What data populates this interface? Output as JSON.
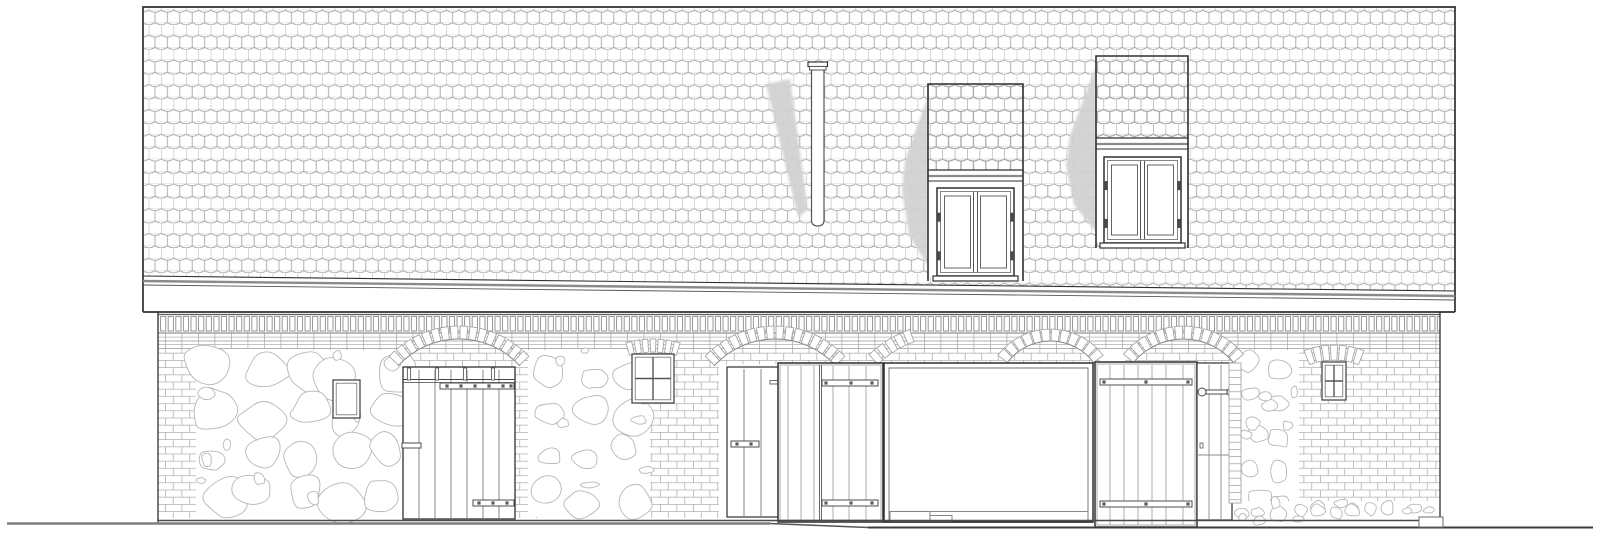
{
  "figure": {
    "kind": "architectural-elevation-drawing",
    "text_content": ""
  },
  "colors": {
    "bg": "#ffffff",
    "ink": "#2f2f2f",
    "mid": "#555555",
    "soft": "#7d7d7d",
    "tile_line": "#a2a2a2",
    "tile_faint": "#d8d8d8",
    "brick_line": "#b0b0b0",
    "band": "#8a8a8a",
    "stone": "#b7b7b7",
    "shadow": "#d2d2d2",
    "ground_l": "#7f7f7f",
    "ground_r": "#3d3d3d",
    "white": "#ffffff"
  },
  "scene": {
    "canvas": {
      "w": 1600,
      "h": 537
    },
    "patterns": {
      "tile": {
        "w": 12.4,
        "h": 12.4,
        "dip": 4.2,
        "head": 2.2
      },
      "brick": {
        "w": 16.5,
        "h": 7.2
      },
      "soldier": {
        "w": 7.6,
        "h": 17.5,
        "bw": 5.2,
        "bh": 14.5
      }
    },
    "roof": {
      "x1": 143,
      "x2": 1455,
      "top": 7,
      "eaveL": 276,
      "eaveR": 291,
      "bottom": 312
    },
    "chimney": {
      "x1": 811.5,
      "x2": 824,
      "top": 70,
      "bottom": 226,
      "cap": {
        "x1": 808,
        "x2": 827.5,
        "y1": 62,
        "y2": 70,
        "mid": 66.5
      },
      "shadow": [
        [
          766,
          84
        ],
        [
          790,
          79
        ],
        [
          808,
          210
        ],
        [
          798,
          217
        ]
      ]
    },
    "dormers": [
      {
        "x1": 928,
        "x2": 1023,
        "top": 84,
        "tiles_bottom": 170,
        "band": [
          170,
          176,
          181,
          188
        ],
        "win": {
          "x1": 937,
          "x2": 1014,
          "y1": 188,
          "y2": 276
        },
        "sill": {
          "x1": 933,
          "x2": 1018,
          "y1": 276,
          "y2": 281
        },
        "shadow": [
          [
            928,
            96
          ],
          [
            905,
            160
          ],
          [
            902,
            190
          ],
          [
            909,
            235
          ],
          [
            928,
            266
          ]
        ]
      },
      {
        "x1": 1096,
        "x2": 1188,
        "top": 56,
        "tiles_bottom": 138,
        "band": [
          138,
          144,
          149,
          157
        ],
        "win": {
          "x1": 1104,
          "x2": 1181,
          "y1": 157,
          "y2": 243
        },
        "sill": {
          "x1": 1100,
          "x2": 1185,
          "y1": 243,
          "y2": 248
        },
        "shadow": [
          [
            1096,
            66
          ],
          [
            1070,
            135
          ],
          [
            1066,
            165
          ],
          [
            1074,
            205
          ],
          [
            1096,
            232
          ]
        ]
      }
    ],
    "wall": {
      "x1": 158,
      "x2": 1440,
      "top": 312,
      "soldier": {
        "y1": 315.5,
        "y2": 333
      },
      "courses": [
        [
          333.5,
          341
        ],
        [
          341,
          348.5
        ]
      ],
      "base": 520.5,
      "base_right": 527
    },
    "brick_regions": [
      {
        "x": 158,
        "y": 348.5,
        "w": 42,
        "h": 169.5
      },
      {
        "x": 300,
        "y": 348.5,
        "w": 98,
        "h": 110
      },
      {
        "x": 513,
        "y": 348.5,
        "w": 33,
        "h": 169.5
      },
      {
        "x": 627,
        "y": 348.5,
        "w": 92,
        "h": 169.5
      },
      {
        "x": 831,
        "y": 348.5,
        "w": 53,
        "h": 15
      },
      {
        "x": 1232,
        "y": 348.5,
        "w": 208,
        "h": 154.5
      },
      {
        "x": 395,
        "y": 348.5,
        "w": 130,
        "h": 18
      },
      {
        "x": 705,
        "y": 348.5,
        "w": 135,
        "h": 16
      },
      {
        "x": 868,
        "y": 348.5,
        "w": 232,
        "h": 15
      },
      {
        "x": 1125,
        "y": 348.5,
        "w": 115,
        "h": 15
      }
    ],
    "stone_regions": [
      {
        "x": 196,
        "y": 350,
        "w": 210,
        "h": 167,
        "cols": 5,
        "rows": 4,
        "rmin": 16,
        "rmax": 27,
        "seed": 7,
        "pebbles": 10
      },
      {
        "x": 528,
        "y": 350,
        "w": 122,
        "h": 167,
        "cols": 3,
        "rows": 4,
        "rmin": 14,
        "rmax": 24,
        "seed": 11,
        "pebbles": 7
      },
      {
        "x": 1239,
        "y": 350,
        "w": 60,
        "h": 167,
        "cols": 2,
        "rows": 5,
        "rmin": 10,
        "rmax": 17,
        "seed": 23,
        "pebbles": 6
      },
      {
        "x": 1232,
        "y": 501,
        "w": 206,
        "h": 20,
        "cols": 11,
        "rows": 1,
        "rmin": 6,
        "rmax": 10,
        "seed": 31,
        "pebbles": 8
      }
    ],
    "arches": [
      {
        "x1": 398,
        "x2": 520,
        "spring": 366,
        "rise": 27,
        "depth": 13,
        "n": 16,
        "arcline": true
      },
      {
        "x1": 714,
        "x2": 836,
        "spring": 366,
        "rise": 27,
        "depth": 13,
        "n": 16,
        "arcline": true
      },
      {
        "x1": 877,
        "x2": 1025,
        "spring": 365,
        "rise": 30,
        "depth": 13,
        "n": 18,
        "clip": [
          870,
          913
        ]
      },
      {
        "x1": 1007,
        "x2": 1094,
        "spring": 363,
        "rise": 22,
        "depth": 12,
        "n": 12,
        "arcline": true
      },
      {
        "x1": 1133,
        "x2": 1234,
        "spring": 363,
        "rise": 24,
        "depth": 13,
        "n": 14,
        "arcline": true
      },
      {
        "x1": 622,
        "x2": 684,
        "spring": 358,
        "rise": 6,
        "depth": 13,
        "n": 9,
        "clip": [
          626,
          680
        ]
      },
      {
        "x1": 1302,
        "x2": 1366,
        "spring": 368,
        "rise": 8,
        "depth": 15,
        "n": 9,
        "clip": [
          1308,
          1360
        ]
      }
    ],
    "small_windows": [
      {
        "x1": 333,
        "x2": 360,
        "y1": 380,
        "y2": 418,
        "cross": false
      },
      {
        "x1": 632,
        "x2": 674,
        "y1": 354,
        "y2": 403,
        "cross": true
      },
      {
        "x1": 1322,
        "x2": 1346,
        "y1": 362,
        "y2": 400,
        "cross": true
      }
    ],
    "door_left": {
      "frame": {
        "x1": 403,
        "x2": 515,
        "y1": 367,
        "y2": 519
      },
      "planks": [
        419,
        435,
        451,
        467,
        483,
        499
      ],
      "rail": {
        "y1": 379.5,
        "y2": 382.5
      },
      "posts": [
        409,
        437,
        465,
        493
      ],
      "post_y": [
        368,
        380
      ],
      "battens": [
        {
          "x1": 440,
          "x2": 514,
          "y1": 383,
          "y2": 389,
          "nails": [
            447,
            461,
            475,
            489,
            503,
            511
          ]
        },
        {
          "x1": 473,
          "x2": 514,
          "y1": 500,
          "y2": 506,
          "nails": [
            479,
            493,
            507
          ]
        }
      ],
      "latch": {
        "x1": 402,
        "x2": 421,
        "y1": 443,
        "y2": 448
      }
    },
    "door_mid": {
      "frame": {
        "x1": 727,
        "x2": 790,
        "y1": 367,
        "y2": 517
      },
      "planks": [
        744,
        761,
        778
      ],
      "battens": [
        {
          "x1": 731,
          "x2": 759,
          "y1": 441,
          "y2": 447,
          "nails": [
            737,
            751
          ]
        }
      ],
      "bolt": {
        "x1": 770,
        "x2": 781,
        "y1": 380.5,
        "y2": 384
      }
    },
    "panel_left": {
      "frame": {
        "x1": 778,
        "x2": 883,
        "y1": 363,
        "y2": 522
      },
      "stile": 820.5,
      "planks": [
        788,
        801,
        814,
        833,
        849,
        866
      ],
      "battens": [
        {
          "x1": 822,
          "x2": 878,
          "y1": 380,
          "y2": 386,
          "bolts": [
            826,
            851,
            872
          ]
        },
        {
          "x1": 822,
          "x2": 878,
          "y1": 500,
          "y2": 506,
          "bolts": [
            826,
            851,
            872
          ]
        }
      ]
    },
    "opening": {
      "x1": 884,
      "x2": 1093,
      "y1": 363,
      "y2": 522,
      "inset": 5,
      "floor": 511.5,
      "steps": [
        {
          "x": 890,
          "y": 511.5,
          "w": 40,
          "h": 10.5
        },
        {
          "x": 930,
          "y": 515.5,
          "w": 22,
          "h": 6.5
        }
      ]
    },
    "panel_right": {
      "frame": {
        "x1": 1095,
        "x2": 1197,
        "y1": 362,
        "y2": 527
      },
      "planks": [
        1110,
        1124,
        1138,
        1152,
        1166,
        1183
      ],
      "battens": [
        {
          "x1": 1100,
          "x2": 1192,
          "y1": 379,
          "y2": 385,
          "bolts": [
            1104,
            1146,
            1188
          ]
        },
        {
          "x1": 1100,
          "x2": 1192,
          "y1": 501,
          "y2": 507,
          "bolts": [
            1104,
            1146,
            1188
          ]
        }
      ]
    },
    "door_right": {
      "frame": {
        "x1": 1197,
        "x2": 1232,
        "y1": 363,
        "y2": 520
      },
      "planks": [
        1209,
        1221
      ],
      "latch": {
        "bar": {
          "x1": 1206,
          "x2": 1227,
          "y1": 390,
          "y2": 394
        },
        "rings": [
          [
            1202,
            392
          ],
          [
            1231,
            392
          ]
        ],
        "r": 4
      },
      "keyhole": {
        "x": 1200,
        "y": 443
      },
      "rail_y": 455,
      "jamb": {
        "x1": 1229,
        "x2": 1241,
        "y1": 363,
        "y2": 503,
        "step": 7.2
      }
    },
    "ground": {
      "segments": [
        {
          "x1": 7,
          "y1": 523.5,
          "x2": 770,
          "y2": 523.5,
          "c": "ground_l",
          "w": 2.6
        },
        {
          "x1": 770,
          "y1": 523.5,
          "x2": 868,
          "y2": 527.5,
          "c": "mid",
          "w": 1.4
        },
        {
          "x1": 868,
          "y1": 527.5,
          "x2": 1593,
          "y2": 527.5,
          "c": "ground_r",
          "w": 2.0
        }
      ],
      "base": {
        "x1": 158,
        "x2": 1440,
        "y": 520.5,
        "w": 1.6
      },
      "plinths": [
        {
          "x": 1419,
          "y": 517,
          "w": 24,
          "h": 10
        }
      ]
    }
  }
}
